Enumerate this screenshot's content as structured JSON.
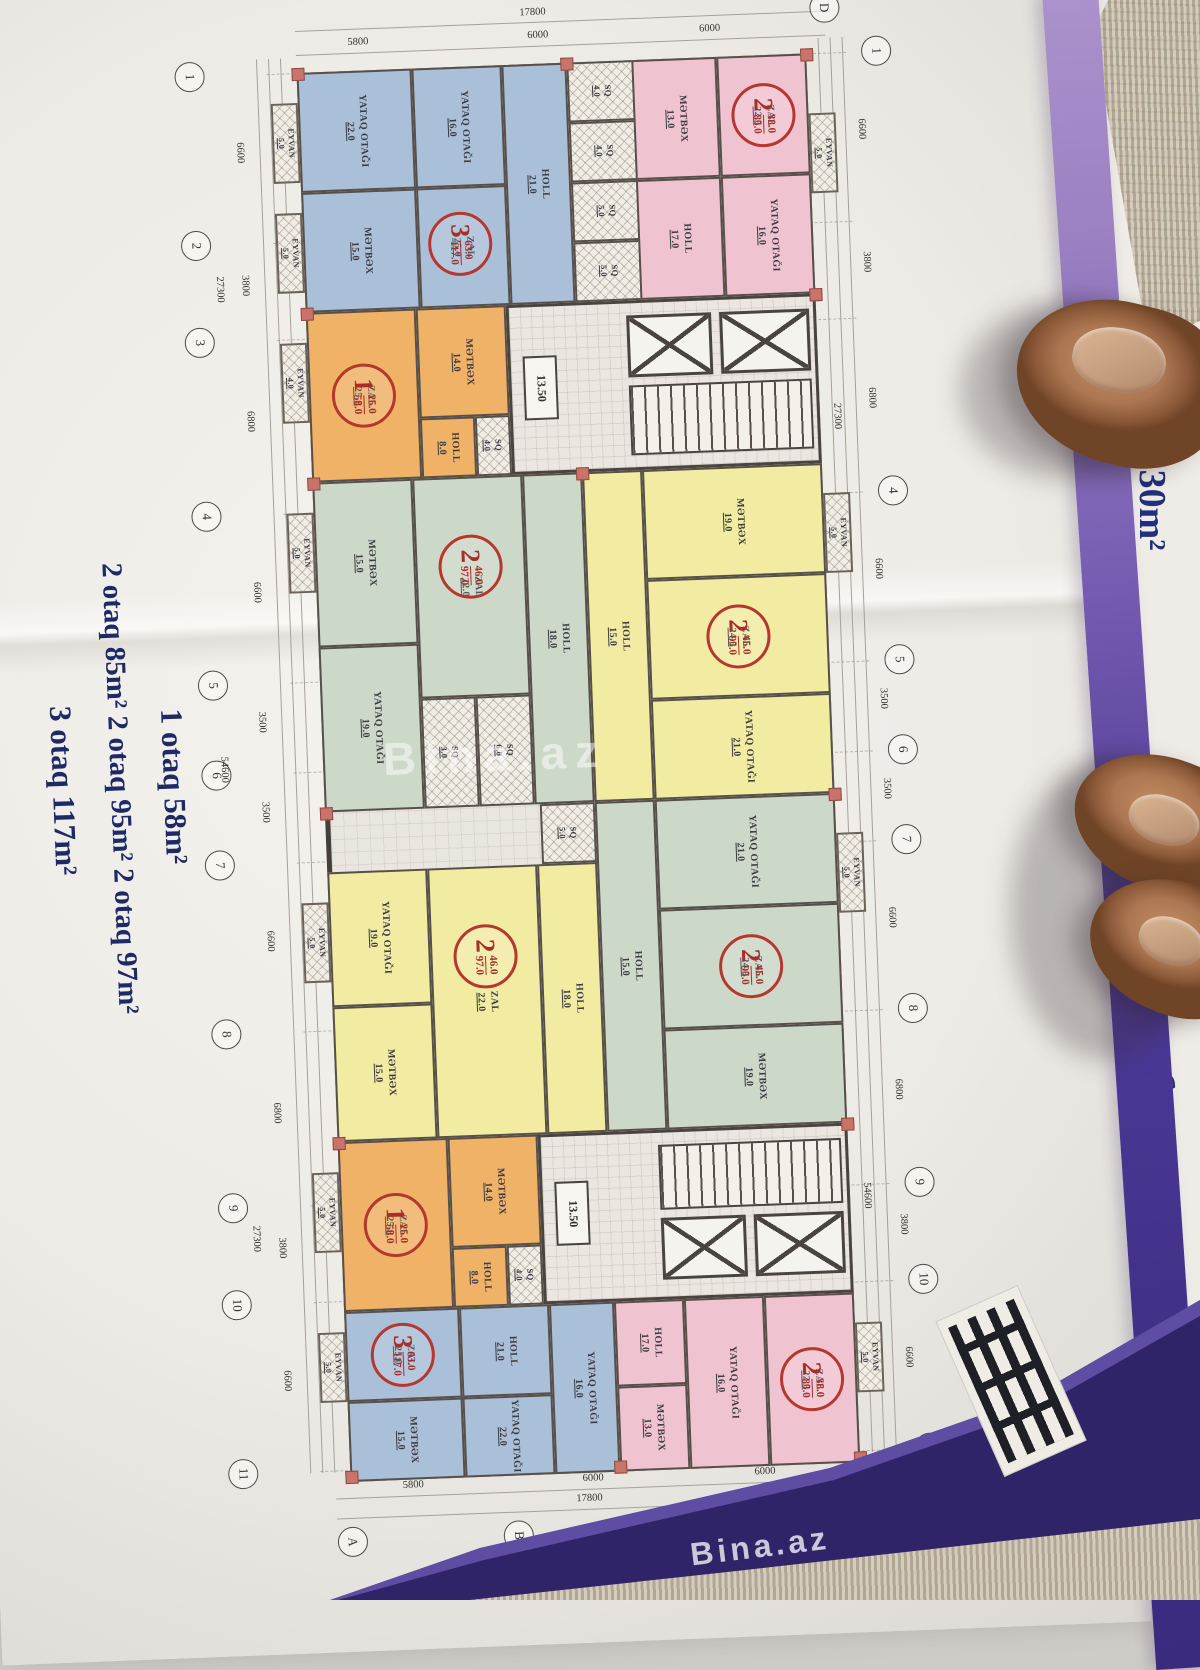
{
  "note": {
    "line1": "1 otaq  58m²",
    "line2": "2 otaq  85m²   2 otaq  95m²   2 otaq  97m²",
    "line3": "3 otaq  117m²"
  },
  "side_page": {
    "text": "q  130m²"
  },
  "watermarks": {
    "center": "Bina.az",
    "bottom": "Bina.az"
  },
  "labels": {
    "sq": "SQ",
    "eyvan": "EYVAN"
  },
  "levels": {
    "core1": "13.50",
    "core2": "13.50"
  },
  "grid": {
    "top": {
      "total": "17800",
      "seg1": "5800",
      "seg2": "6000",
      "seg3": "6000",
      "bubble": "D"
    },
    "bottom": {
      "total": "17800",
      "seg1": "5800",
      "seg2": "6000",
      "seg3": "6000",
      "bubbles": [
        "A",
        "B",
        "C",
        "D"
      ]
    },
    "left": {
      "bubbles": [
        "1",
        "2",
        "3",
        "4",
        "5",
        "6",
        "7",
        "8",
        "9",
        "10",
        "11"
      ],
      "dims": [
        "6600",
        "3800",
        "6800",
        "6600",
        "3500",
        "3500",
        "6600",
        "6800",
        "3800",
        "6600"
      ],
      "totals": [
        "27300",
        "54600",
        "27300"
      ]
    },
    "right": {
      "bubbles": [
        "1",
        "4",
        "5",
        "6",
        "7",
        "8",
        "9",
        "10",
        "11"
      ],
      "dims": [
        "6600",
        "3800",
        "6800",
        "6600",
        "3500",
        "3500",
        "6600",
        "6800",
        "3800",
        "6600"
      ],
      "totals": [
        "27300",
        "54600"
      ]
    }
  },
  "sq_units": [
    "4.0",
    "4.0",
    "5.0",
    "5.0",
    "3.0",
    "6.0",
    "5.0",
    "4.0"
  ],
  "eyvans": [
    "5.0",
    "5.0",
    "4.0",
    "5.0",
    "5.0",
    "5.0",
    "5.0",
    "5.0",
    "5.0",
    "5.0",
    "5.0"
  ],
  "apartments": [
    {
      "color": "blue",
      "badge": {
        "count": "3",
        "living": "63.0",
        "total": "117.0"
      },
      "rooms": [
        {
          "name": "ZAL",
          "area": "25.0"
        },
        {
          "name": "HOLL",
          "area": "21.0"
        },
        {
          "name": "MƏTBƏX",
          "area": "15.0"
        },
        {
          "name": "YATAQ OTAĞI",
          "area": "22.0"
        },
        {
          "name": "YATAQ OTAĞI",
          "area": "16.0"
        }
      ]
    },
    {
      "color": "pink",
      "badge": {
        "count": "2",
        "living": "38.0",
        "total": "85.0"
      },
      "rooms": [
        {
          "name": "ZAL",
          "area": "22.0"
        },
        {
          "name": "YATAQ OTAĞI",
          "area": "16.0"
        },
        {
          "name": "MƏTBƏX",
          "area": "13.0"
        },
        {
          "name": "HOLL",
          "area": "17.0"
        }
      ]
    },
    {
      "color": "orange",
      "badge": {
        "count": "1",
        "living": "25.0",
        "total": "58.0"
      },
      "rooms": [
        {
          "name": "ZAL",
          "area": "25.0"
        },
        {
          "name": "MƏTBƏX",
          "area": "14.0"
        },
        {
          "name": "HOLL",
          "area": "8.0"
        },
        {
          "name": "SQ",
          "area": "4.0"
        }
      ]
    },
    {
      "color": "green",
      "badge": {
        "count": "2",
        "living": "46.0",
        "total": "97.0"
      },
      "rooms": [
        {
          "name": "ZAL",
          "area": "22.0"
        },
        {
          "name": "MƏTBƏX",
          "area": "15.0"
        },
        {
          "name": "YATAQ OTAĞI",
          "area": "19.0"
        },
        {
          "name": "HOLL",
          "area": "18.0"
        }
      ]
    },
    {
      "color": "yellow",
      "badge": {
        "count": "2",
        "living": "45.0",
        "total": "95.0"
      },
      "rooms": [
        {
          "name": "ZAL",
          "area": "24.0"
        },
        {
          "name": "MƏTBƏX",
          "area": "19.0"
        },
        {
          "name": "YATAQ OTAĞI",
          "area": "21.0"
        },
        {
          "name": "HOLL",
          "area": "15.0"
        }
      ]
    },
    {
      "color": "yellow",
      "badge": {
        "count": "2",
        "living": "46.0",
        "total": "97.0"
      },
      "rooms": [
        {
          "name": "ZAL",
          "area": "22.0"
        },
        {
          "name": "MƏTBƏX",
          "area": "15.0"
        },
        {
          "name": "YATAQ OTAĞI",
          "area": "19.0"
        },
        {
          "name": "HOLL",
          "area": "18.0"
        }
      ]
    },
    {
      "color": "green",
      "badge": {
        "count": "2",
        "living": "45.0",
        "total": "95.0"
      },
      "rooms": [
        {
          "name": "ZAL",
          "area": "24.0"
        },
        {
          "name": "MƏTBƏX",
          "area": "19.0"
        },
        {
          "name": "YATAQ OTAĞI",
          "area": "21.0"
        },
        {
          "name": "HOLL",
          "area": "15.0"
        }
      ]
    },
    {
      "color": "orange",
      "badge": {
        "count": "1",
        "living": "25.0",
        "total": "58.0"
      },
      "rooms": [
        {
          "name": "ZAL",
          "area": "25.0"
        },
        {
          "name": "MƏTBƏX",
          "area": "14.0"
        },
        {
          "name": "HOLL",
          "area": "8.0"
        },
        {
          "name": "SQ",
          "area": "4.0"
        }
      ]
    },
    {
      "color": "blue",
      "badge": {
        "count": "3",
        "living": "63.0",
        "total": "117.0"
      },
      "rooms": [
        {
          "name": "ZAL",
          "area": "25.0"
        },
        {
          "name": "HOLL",
          "area": "21.0"
        },
        {
          "name": "MƏTBƏX",
          "area": "15.0"
        },
        {
          "name": "YATAQ OTAĞI",
          "area": "22.0"
        },
        {
          "name": "YATAQ OTAĞI",
          "area": "16.0"
        }
      ]
    },
    {
      "color": "pink",
      "badge": {
        "count": "2",
        "living": "38.0",
        "total": "85.0"
      },
      "rooms": [
        {
          "name": "ZAL",
          "area": "22.0"
        },
        {
          "name": "YATAQ OTAĞI",
          "area": "16.0"
        },
        {
          "name": "MƏTBƏX",
          "area": "13.0"
        },
        {
          "name": "HOLL",
          "area": "17.0"
        }
      ]
    }
  ]
}
